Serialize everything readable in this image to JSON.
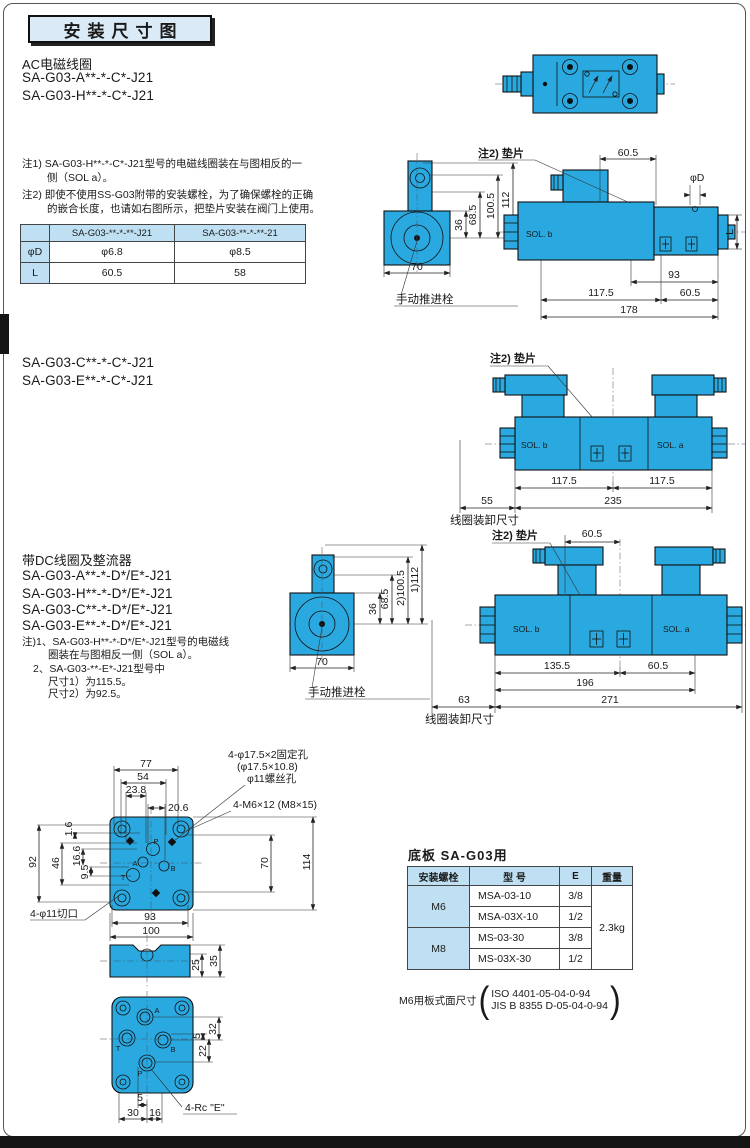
{
  "colors": {
    "valve": "#2AA9E0",
    "light_blue": "#BFE0F2",
    "title_bg": "#DAEBF7"
  },
  "title": "安装尺寸图",
  "ac": {
    "heading": "AC电磁线圈",
    "model1": "SA-G03-A**-*-C*-J21",
    "model2": "SA-G03-H**-*-C*-J21",
    "note1a": "注1) SA-G03-H**-*-C*-J21型号的电磁线圈装在与图相反的一",
    "note1b": "侧（SOL a）。",
    "note2a": "注2) 即使不使用SS-G03附带的安装螺栓，为了确保螺栓的正确",
    "note2b": "的嵌合长度，也请如右图所示，把垫片安装在阀门上使用。"
  },
  "spec": {
    "h1": "SA-G03-**-*-**-J21",
    "h2": "SA-G03-**-*-**-21",
    "r1label": "φD",
    "r1v1": "φ6.8",
    "r1v2": "φ8.5",
    "r2label": "L",
    "r2v1": "60.5",
    "r2v2": "58"
  },
  "mid": {
    "model1": "SA-G03-C**-*-C*-J21",
    "model2": "SA-G03-E**-*-C*-J21"
  },
  "dc": {
    "heading": "带DC线圈及整流器",
    "model1": "SA-G03-A**-*-D*/E*-J21",
    "model2": "SA-G03-H**-*-D*/E*-J21",
    "model3": "SA-G03-C**-*-D*/E*-J21",
    "model4": "SA-G03-E**-*-D*/E*-J21",
    "note1a": "注)1、SA-G03-H**-*-D*/E*-J21型号的电磁线",
    "note1b": "圈装在与图相反一侧（SOL a）。",
    "note2a": "2、SA-G03-**-E*-J21型号中",
    "note2b": "尺寸1）为115.5。",
    "note2c": "尺寸2）为92.5。"
  },
  "d1": {
    "shim": "注2) 垫片",
    "top605": "60.5",
    "phid": "φD",
    "L": "L",
    "solb": "SOL. b",
    "v36": "36",
    "v685": "68.5",
    "v1005": "100.5",
    "v112": "112",
    "v70": "70",
    "manual": "手动推进栓",
    "v93": "93",
    "v1175": "117.5",
    "v605": "60.5",
    "v178": "178"
  },
  "d2": {
    "shim": "注2) 垫片",
    "solb": "SOL. b",
    "sola": "SOL. a",
    "l1175": "117.5",
    "r1175": "117.5",
    "v55": "55",
    "v235": "235",
    "coil": "线圈装卸尺寸"
  },
  "d3": {
    "v36": "36",
    "v685": "68.5",
    "v1005": "2)100.5",
    "v112": "1)112",
    "v70": "70",
    "manual": "手动推进栓",
    "shim": "注2) 垫片",
    "top605": "60.5",
    "solb": "SOL. b",
    "sola": "SOL. a",
    "v1355": "135.5",
    "v605": "60.5",
    "v196": "196",
    "v63": "63",
    "v271": "271",
    "coil": "线圈装卸尺寸"
  },
  "d4": {
    "v77": "77",
    "v54": "54",
    "v238": "23.8",
    "v206": "20.6",
    "v92": "92",
    "v46": "46",
    "v166": "16.6",
    "v95": "9.5",
    "v16": "1.6",
    "v70": "70",
    "v114": "114",
    "v93": "93",
    "v100": "100",
    "fix1": "4-φ17.5×2固定孔",
    "fix2": "(φ17.5×10.8)",
    "fix3": "φ11螺丝孔",
    "bolt": "4-M6×12 (M8×15)",
    "notch": "4-φ11切口",
    "p": "P",
    "a": "A",
    "b": "B",
    "t": "T"
  },
  "d5": {
    "v25": "25",
    "v35": "35"
  },
  "d6": {
    "a": "A",
    "b": "B",
    "p": "P",
    "t": "T",
    "v5r": "5",
    "v32": "32",
    "v22": "22",
    "v5b": "5",
    "v30": "30",
    "v16": "16",
    "rc": "4-Rc \"E\""
  },
  "plate": {
    "title": "底板  SA-G03用",
    "h1": "安装螺栓",
    "h2": "型    号",
    "h3": "E",
    "h4": "重量",
    "m6": "M6",
    "m8": "M8",
    "r1m": "MSA-03-10",
    "r1e": "3/8",
    "r2m": "MSA-03X-10",
    "r2e": "1/2",
    "r3m": "MS-03-30",
    "r3e": "3/8",
    "r4m": "MS-03X-30",
    "r4e": "1/2",
    "weight": "2.3kg",
    "foot": "M6用板式面尺寸",
    "iso": "ISO 4401-05-04-0-94",
    "jis": "JIS B 8355 D-05-04-0-94"
  }
}
